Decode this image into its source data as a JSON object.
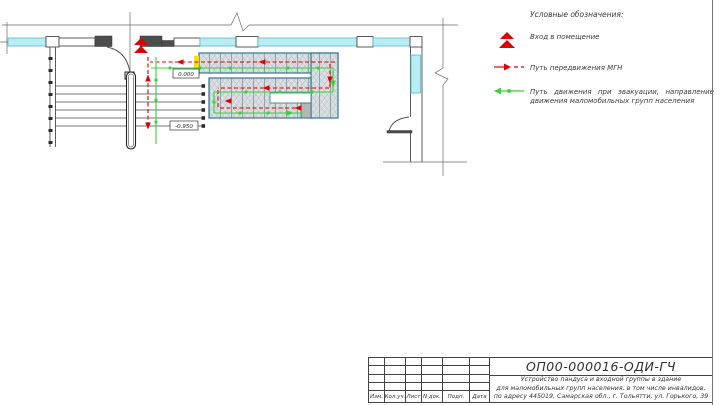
{
  "colors": {
    "path_red": "#dd0000",
    "path_green": "#3ecf3e",
    "window_cyan": "#b9ecf3",
    "ramp_teal": "#2e7d8c",
    "landing_yellow": "#ffdf00",
    "ink": "#3a3a3a"
  },
  "plan": {
    "elevation_zero": "0.000",
    "elevation_lower": "-0.950"
  },
  "legend": {
    "title": "Условные обозначения:",
    "items": [
      {
        "label": "Вход в помещение"
      },
      {
        "label": "Путь передвижения МГН"
      },
      {
        "label": "Путь движения при эвакуации, направление движения маломобильных групп населения"
      }
    ]
  },
  "title_block": {
    "code": "ОП00-000016-ОДИ-ГЧ",
    "description_lines": [
      "Устройство пандуса и входной группы в здание",
      "для маломобильных групп населения, в том числе инвалидов,",
      "по адресу 445019, Самарская обл., г. Тольятти, ул. Горького, 39"
    ]
  },
  "revision_table": {
    "headers": [
      "Изм.",
      "Кол.уч.",
      "Лист",
      "N док.",
      "Подп.",
      "Дата"
    ]
  }
}
